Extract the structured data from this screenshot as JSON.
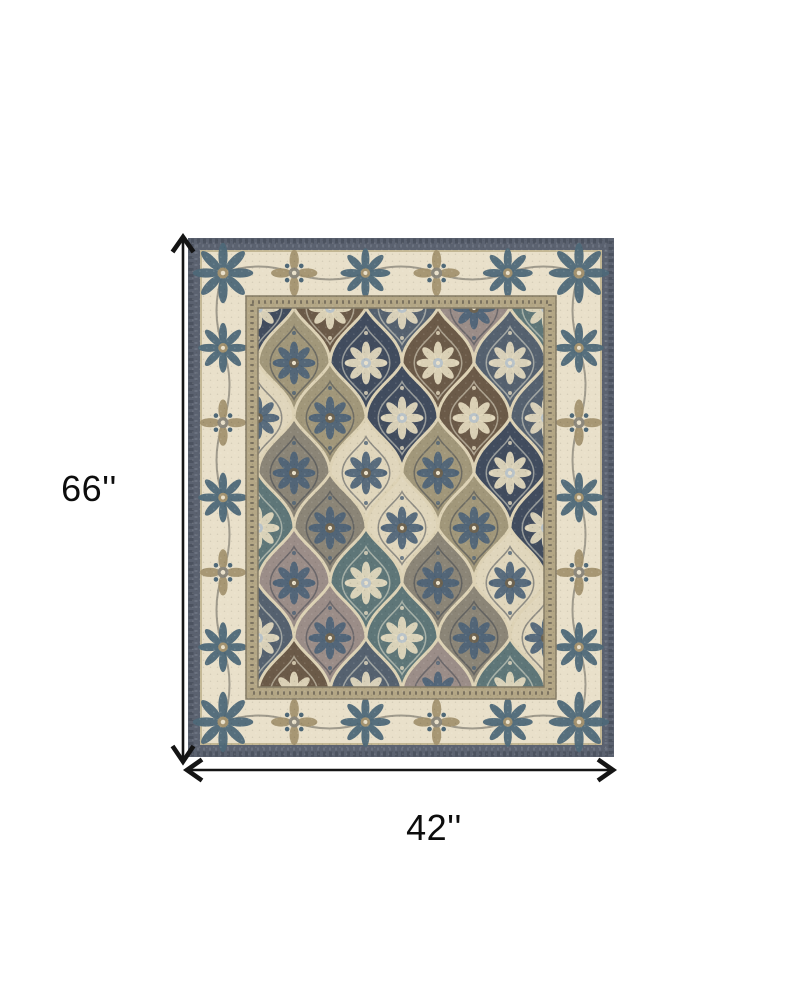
{
  "diagram": {
    "kind": "product-dimensions",
    "background": "#ffffff"
  },
  "dimensions": {
    "height_label": "66''",
    "width_label": "42''",
    "arrow_color": "#141414",
    "label_color": "#0d0d0d"
  },
  "rug": {
    "description": "Traditional patchwork area rug: ivory floral border, dark slate edge, ogee panel field in navy, teal, taupe, brown and cream",
    "palette": {
      "outer_edge": "#5b6270",
      "outer_edge_dark": "#454c58",
      "outer_edge_light": "#7b8290",
      "border_ivory": "#e9e0ca",
      "border_line_tan": "#c3b794",
      "border_motif_blue": "#4e6878",
      "border_motif_taupe": "#a3926f",
      "border_motif_gray": "#8c887c",
      "frame_tan": "#b3a685",
      "frame_dark": "#6e6757",
      "frame_line": "#857c66",
      "field_base": "#cfc3a7",
      "lattice_cream": "#ddd2b5",
      "panels": [
        "#414c5e",
        "#9b8d88",
        "#e0d6bc",
        "#6b5a48",
        "#5e7678",
        "#a1977a",
        "#55616f",
        "#8b8577"
      ]
    }
  }
}
